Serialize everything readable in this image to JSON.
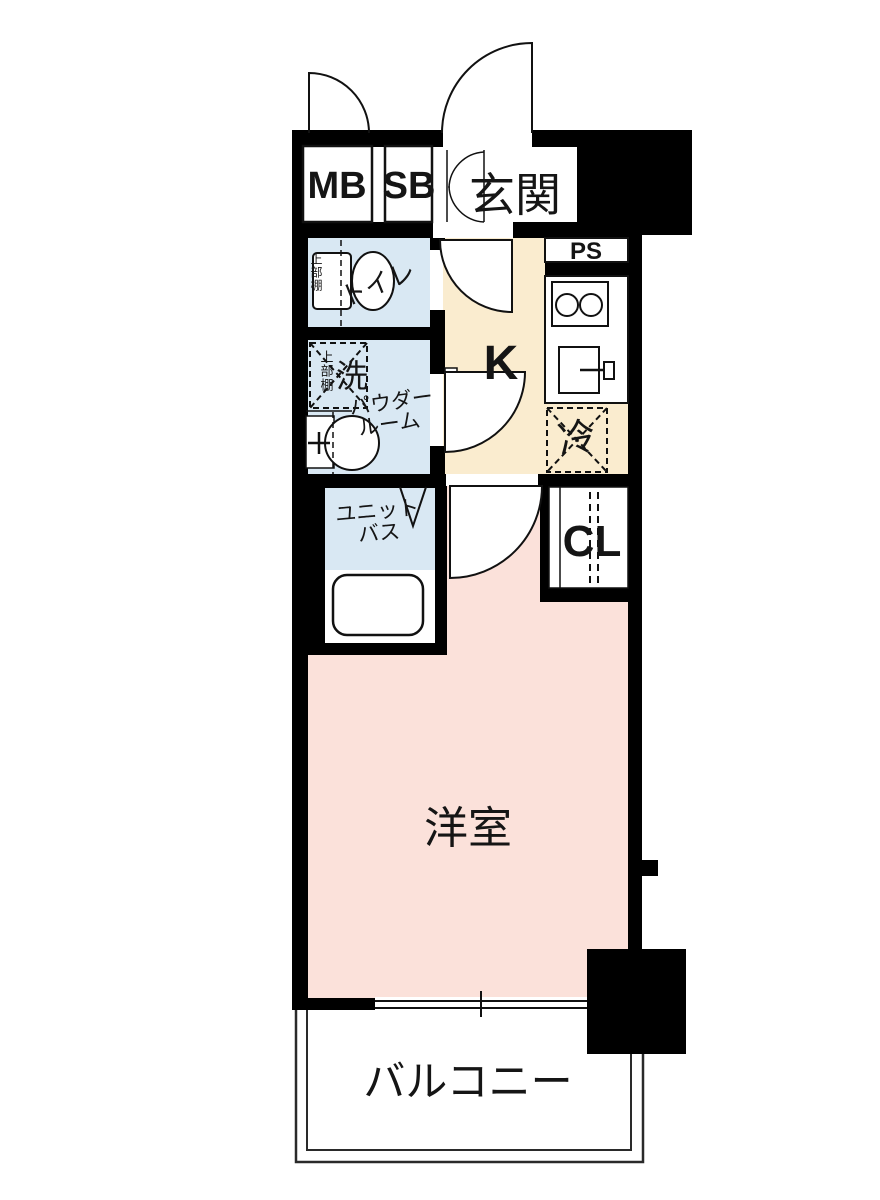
{
  "floorplan": {
    "type": "studio-apartment-floor-plan",
    "labels": {
      "meter_box": "MB",
      "shoe_box": "SB",
      "entrance": "玄関",
      "pipe_space": "PS",
      "toilet": "トイレ",
      "toilet_upper_shelf": "上部棚",
      "kitchen": "K",
      "refrigerator": "冷",
      "powder_upper_shelf": "上部棚",
      "washer": "洗",
      "powder_room_line1": "パウダー",
      "powder_room_line2": "ルーム",
      "unit_bath_line1": "ユニット",
      "unit_bath_line2": "バス",
      "closet": "CL",
      "western_room": "洋室",
      "balcony": "バルコニー"
    },
    "colors": {
      "wall": "#000000",
      "line": "#1a1a1a",
      "thin_line": "#2a2a2a",
      "floor_blue": "#d9e8f3",
      "floor_cream": "#faeccf",
      "floor_pink": "#fbe1da",
      "fixture_fill": "#ffffff"
    }
  }
}
